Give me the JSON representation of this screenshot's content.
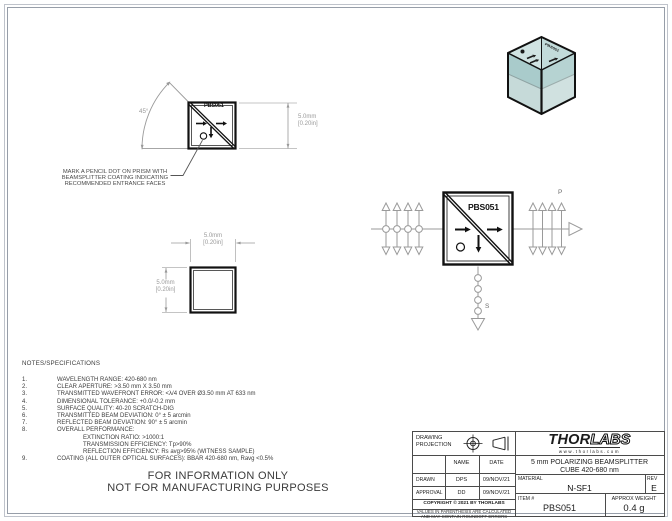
{
  "views": {
    "marking_view": {
      "cube_label": "PBS051",
      "angle": "45°",
      "height_dim": {
        "mm": "5.0mm",
        "in": "[0.20in]"
      },
      "note_lines": [
        "MARK A PENCIL DOT ON PRISM WITH",
        "BEAMSPLITTER COATING INDICATING",
        "RECOMMENDED ENTRANCE FACES"
      ]
    },
    "front_view": {
      "width_dim": {
        "mm": "5.0mm",
        "in": "[0.20in]"
      },
      "height_dim": {
        "mm": "5.0mm",
        "in": "[0.20in]"
      }
    },
    "beam_diagram": {
      "cube_label": "PBS051",
      "p_polarization_label": "P",
      "s_polarization_label": "S"
    },
    "iso_view": {
      "cube_label": "PBS051"
    }
  },
  "notes": {
    "heading": "NOTES/SPECIFICATIONS",
    "items": [
      {
        "num": "1.",
        "text": "WAVELENGTH RANGE: 420-680 nm"
      },
      {
        "num": "2.",
        "text": "CLEAR APERTURE: >3.50 mm X 3.50 mm"
      },
      {
        "num": "3.",
        "text": "TRANSMITTED WAVEFRONT ERROR: <λ/4 OVER Ø3.50 mm AT 633 nm"
      },
      {
        "num": "4.",
        "text": "DIMENSIONAL TOLERANCE: +0.0/-0.2 mm"
      },
      {
        "num": "5.",
        "text": "SURFACE QUALITY: 40-20 SCRATCH-DIG"
      },
      {
        "num": "6.",
        "text": "TRANSMITTED BEAM DEVIATION: 0° ± 5 arcmin"
      },
      {
        "num": "7.",
        "text": "REFLECTED BEAM DEVIATION: 90° ± 5 arcmin"
      },
      {
        "num": "8.",
        "text": "OVERALL PERFORMANCE:"
      },
      {
        "num": "",
        "text": "EXTINCTION RATIO: >1000:1"
      },
      {
        "num": "",
        "text": "TRANSMISSION EFFICIENCY: Tp>90%"
      },
      {
        "num": "",
        "text": "REFLECTION EFFICIENCY: Rs avg>95% (WITNESS SAMPLE)"
      },
      {
        "num": "9.",
        "text": "COATING (ALL OUTER OPTICAL SURFACES): BBAR 420-680 nm, Ravg <0.5%"
      }
    ],
    "disclaimer": [
      "FOR INFORMATION ONLY",
      "NOT FOR MANUFACTURING PURPOSES"
    ]
  },
  "title_block": {
    "projection_label": "DRAWING PROJECTION",
    "col_headers": {
      "name": "NAME",
      "date": "DATE"
    },
    "drawn": {
      "label": "DRAWN",
      "name": "DPS",
      "date": "09/NOV/21"
    },
    "approval": {
      "label": "APPROVAL",
      "name": "DD",
      "date": "09/NOV/21"
    },
    "copyright": "COPYRIGHT © 2021 BY THORLABS",
    "parenthesis_note": [
      "VALUES IN PARENTHESIS ARE CALCULATED",
      "AND MAY CONTAIN ROUNDOFF ERRORS"
    ],
    "logo": {
      "part1": "THOR",
      "part2": "LABS",
      "url": "www.thorlabs.com"
    },
    "drawing_title": [
      "5 mm POLARIZING BEAMSPLITTER",
      "CUBE 420-680 nm"
    ],
    "material": {
      "label": "MATERIAL",
      "value": "N-SF1"
    },
    "rev": {
      "label": "REV",
      "value": "E"
    },
    "item": {
      "label": "ITEM #",
      "value": "PBS051"
    },
    "weight": {
      "label": "APPROX WEIGHT",
      "value": "0.4 g"
    }
  },
  "colors": {
    "glass_face": "#b6d3d2",
    "line_gray": "#9a9a9a",
    "ink": "#111111"
  }
}
